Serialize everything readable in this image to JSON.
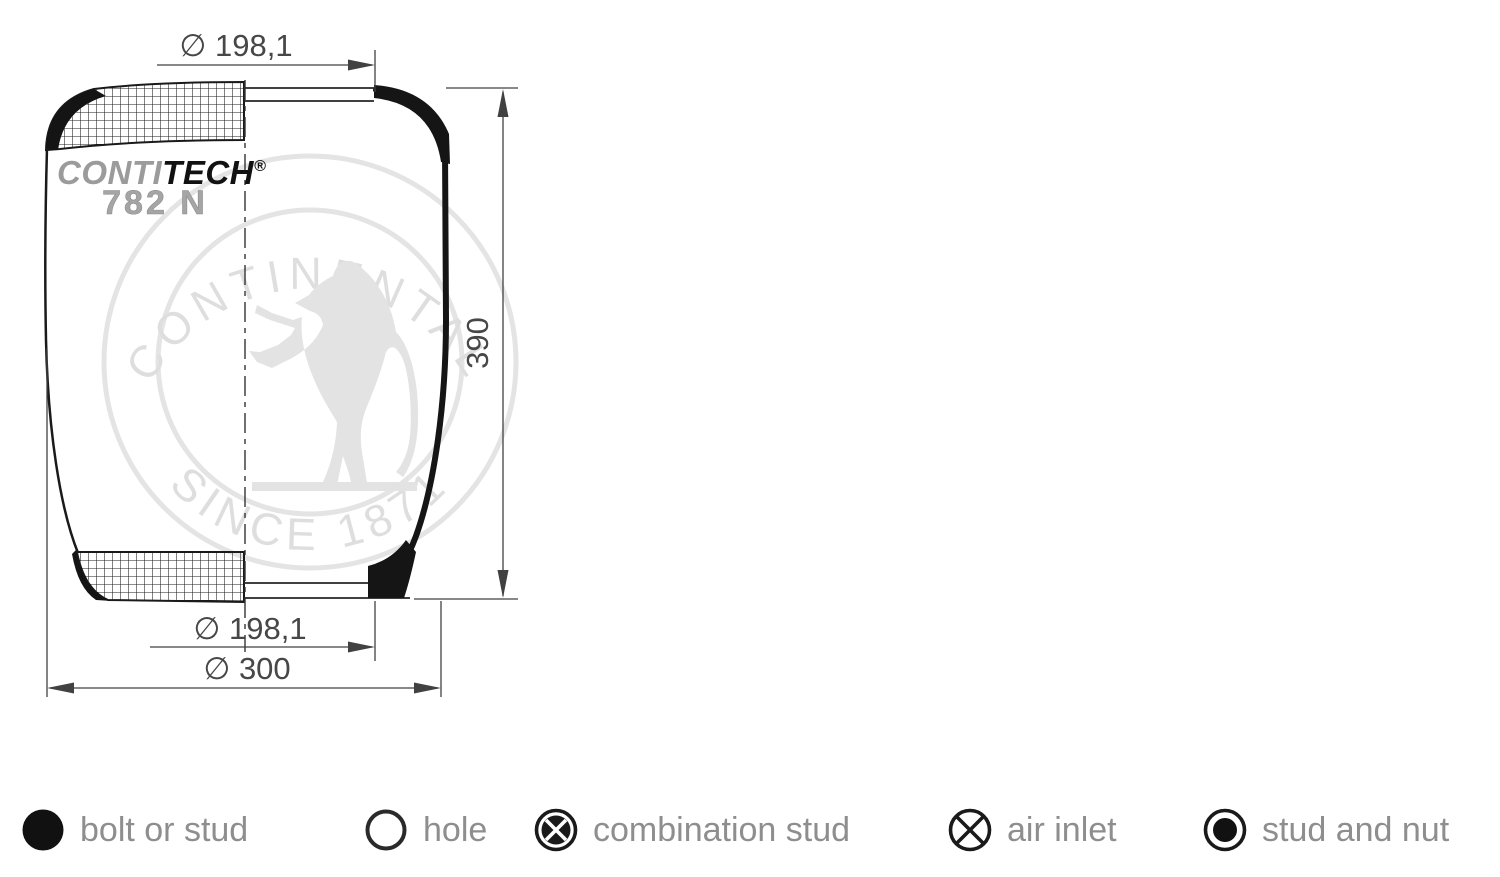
{
  "drawing": {
    "dim_top_diameter": "∅ 198,1",
    "dim_height": "390",
    "dim_bottom_diameter": "∅ 198,1",
    "dim_overall_diameter": "∅ 300",
    "logo_conti": "CONTI",
    "logo_tech": "TECH",
    "logo_reg": "®",
    "logo_model": "782 N",
    "watermark_top_text": "CONTINENTAL",
    "watermark_bottom_text": "SINCE 1871"
  },
  "legend": {
    "items": [
      {
        "symbol": "bolt-or-stud",
        "label": "bolt or stud"
      },
      {
        "symbol": "hole",
        "label": "hole"
      },
      {
        "symbol": "combination-stud",
        "label": "combination stud"
      },
      {
        "symbol": "air-inlet",
        "label": "air inlet"
      },
      {
        "symbol": "stud-and-nut",
        "label": "stud and nut"
      }
    ]
  },
  "colors": {
    "outline": "#161616",
    "dimension_lines": "#414141",
    "dimension_text": "#474747",
    "watermark": "#e2e2e2",
    "legend_text": "#8e8e8e",
    "logo_gray": "#9b9b9b"
  }
}
